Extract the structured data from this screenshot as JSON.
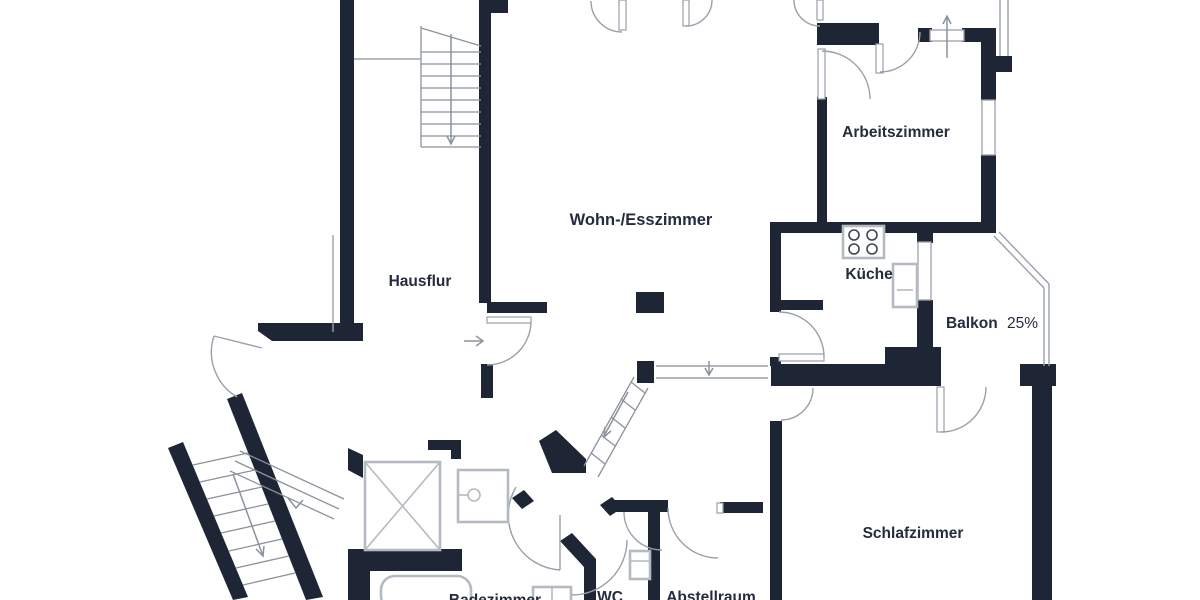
{
  "plan": {
    "rooms": {
      "hausflur": {
        "label": "Hausflur"
      },
      "wohn_esszimmer": {
        "label": "Wohn-/Esszimmer"
      },
      "arbeitszimmer": {
        "label": "Arbeitszimmer"
      },
      "kueche": {
        "label": "Küche"
      },
      "balkon": {
        "label": "Balkon",
        "value": "25%"
      },
      "schlafzimmer": {
        "label": "Schlafzimmer"
      },
      "wc": {
        "label": "WC"
      },
      "abstellraum": {
        "label": "Abstellraum"
      },
      "badezimmer": {
        "label": "Badezimmer"
      }
    },
    "colors": {
      "wall": "#1e2534",
      "line": "#9aa0aa",
      "fixture": "#b4bac2",
      "stair": "#8b929d",
      "text": "#242c3e",
      "background": "#ffffff"
    },
    "symbols": {
      "stove": "4-burner cooktop",
      "sink": "kitchen sink counter",
      "shower": "shower base with drain",
      "bathtub": "bathtub",
      "washer": "washing appliance",
      "wc_basin": "WC basin",
      "elevator_shaft": "shaft marked with X",
      "stairs_main": "straight stair run with down arrow",
      "stairs_basement": "diagonal stair run with down arrow",
      "stairs_split": "short split-level steps",
      "entrance_arrow": "entry direction arrow"
    }
  }
}
